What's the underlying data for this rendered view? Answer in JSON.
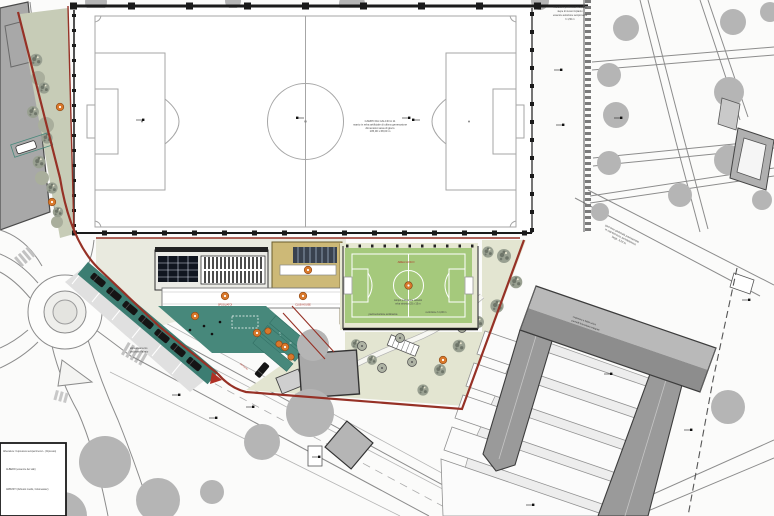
{
  "plan": {
    "kind": "site plan of sports facility with football pitch, mini pitch, clubhouse buildings, park and roads"
  },
  "colors": {
    "background": "#fbfbfa",
    "field_line_gray": "#a6a6a6",
    "fence_black": "#1a1a1a",
    "boundary_red": "#963126",
    "strip_green_gray": "#c7ccb7",
    "tree_gray": "#b5b5b5",
    "tree_texture_base": "#99a091",
    "tree_texture_dark": "#6e7569",
    "garden_ground": "#e3e5d1",
    "teal_play": "#47887b",
    "teal_dark": "#3c7d72",
    "tan_building": "#cdb977",
    "dark_grid_roof": "#10151f",
    "dark_stripe_block": "#39424f",
    "canopy_white": "#ffffff",
    "marker_orange": "#d8782b",
    "pitch_green": "#a5c97c",
    "pitch_margin": "#e6e8d2",
    "roof_gray": "#8d8d8d",
    "roof_light": "#b9b9b9",
    "wing_gray": "#9a9a9a",
    "courtyard_gray": "#ededed",
    "building_gray": "#a8a8a8",
    "road_gray": "#8c8c8c"
  },
  "legend": {
    "items": [
      "Alberature: Cupressus sempervirens L. (Cipresso)",
      "ALBERO (essenze dei viali)",
      "ARBUSTI (Arbusto medio, Cotoneaster)"
    ]
  },
  "annotations": {
    "field_center": {
      "lines": [
        "CAMPO DA CALCIO A 11",
        "manto in erba artificiale di ultima generazione",
        "dimensioni area di gioco",
        "105,00 x 68,00 m"
      ]
    },
    "top_right": {
      "lines": [
        "recinzione perimetrale h 2,00 m",
        "siepe di nuovo impianto",
        "essenze autoctone sempreverdi",
        "h 1,50 m"
      ]
    },
    "park_walk": {
      "lines": [
        "percorso pedonale pavimentato",
        "in calcestruzzo architettonico",
        "largh. 3,00 m"
      ]
    },
    "roof": {
      "lines": [
        "copertura a falda unica",
        "pannelli fotovoltaici integrati"
      ]
    },
    "mini_pitch": {
      "title": "AREA GIOCO",
      "sub1": "campo polivalente calcetto",
      "sub2": "erba sintetica 25 x 15 m",
      "bottom_left": "pavimentazione antitrauma",
      "bottom_right": "recinzione h 4,00 m"
    },
    "canopy": {
      "label1": "SPOGLIATOI",
      "label2": "CLUB HOUSE"
    },
    "near_road": {
      "lines": [
        "area di sosta",
        "e di manovra"
      ]
    },
    "roundabout": {
      "lines": [
        "attraversamento",
        "pedonale rialzato"
      ]
    },
    "path_red": "percorso"
  }
}
